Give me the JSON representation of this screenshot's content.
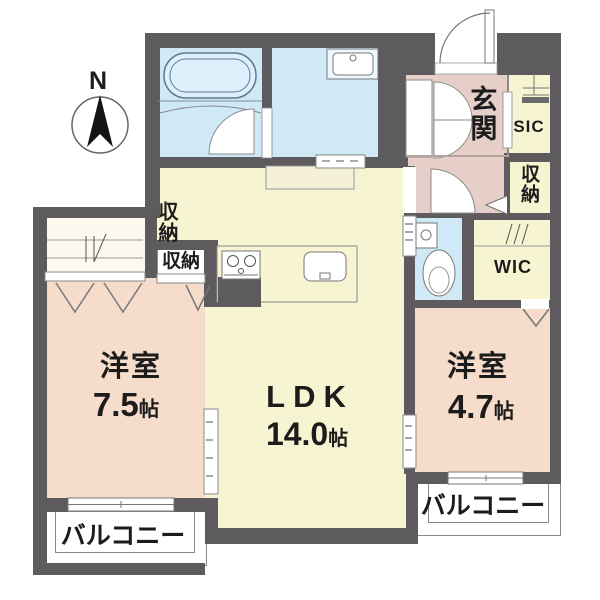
{
  "compass": {
    "label": "N"
  },
  "rooms": {
    "ldk": {
      "label": "LDK",
      "area": "14.0",
      "unit": "帖"
    },
    "bedroom_left": {
      "label": "洋室",
      "area": "7.5",
      "unit": "帖"
    },
    "bedroom_right": {
      "label": "洋室",
      "area": "4.7",
      "unit": "帖"
    },
    "entrance": {
      "label": "玄関"
    },
    "shoe_closet": {
      "label": "SIC"
    },
    "walk_in_closet": {
      "label": "WIC"
    },
    "storage_ldk": {
      "label": "収納"
    },
    "storage_bedroom": {
      "label": "収納"
    },
    "storage_hall": {
      "label": "収納"
    },
    "balcony_left": {
      "label": "バルコニー"
    },
    "balcony_right": {
      "label": "バルコニー"
    }
  },
  "colors": {
    "wall": "#5e5b5e",
    "outline": "#8a8a8a",
    "text": "#1c1c1c",
    "ldk": "#f7f4d2",
    "bed": "#f5dccb",
    "ent": "#e6cfc9",
    "wet": "#cfe9f6",
    "cream": "#fcfaee",
    "tub": "#5d7d8e",
    "thresh": "#b5a49e"
  }
}
